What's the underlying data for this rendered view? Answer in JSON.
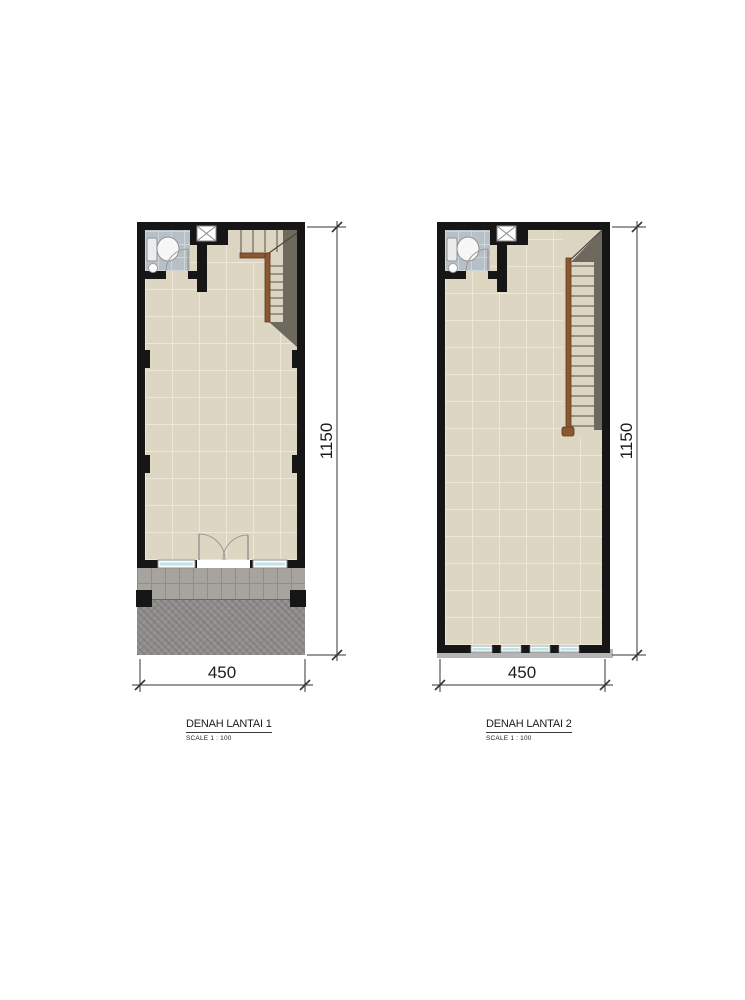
{
  "document": {
    "kind": "architectural floor plan sheet",
    "background": "#ffffff"
  },
  "plans": [
    {
      "title": "DENAH LANTAI 1",
      "scale_label": "SCALE 1 :  100",
      "width_dim": "450",
      "height_dim": "1150"
    },
    {
      "title": "DENAH LANTAI 2",
      "scale_label": "SCALE 1 :  100",
      "width_dim": "450",
      "height_dim": "1150"
    }
  ],
  "colors": {
    "wall": "#161616",
    "floor_tile": "#ddd6c2",
    "floor_grout": "#ece7d8",
    "bathroom_tile": "#b7c0c7",
    "porch_tile": "#a7a4a0",
    "driveway_paving": "#8e8d8b",
    "stair_shadow": "#6e695e",
    "stair_railing": "#8a5732",
    "window_glass": "#bfe4ec",
    "dimension_line": "#333333"
  }
}
